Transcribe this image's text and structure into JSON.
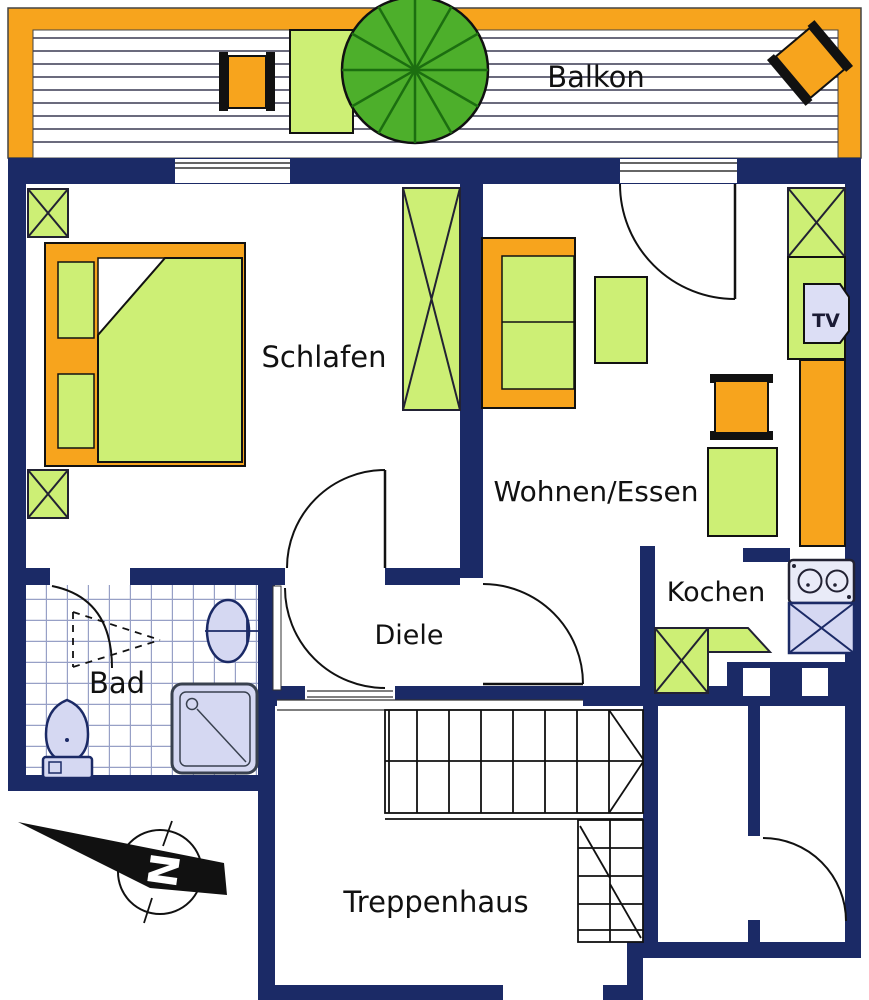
{
  "title": "Apartment floor plan",
  "rooms": {
    "balkon": {
      "label": "Balkon"
    },
    "schlafen": {
      "label": "Schlafen"
    },
    "wohnen_essen": {
      "label": "Wohnen/Essen"
    },
    "kochen": {
      "label": "Kochen"
    },
    "diele": {
      "label": "Diele"
    },
    "bad": {
      "label": "Bad"
    },
    "treppenhaus": {
      "label": "Treppenhaus"
    }
  },
  "furniture": {
    "tv_label": "TV"
  },
  "compass": {
    "north_label": "N"
  },
  "colors": {
    "wall_navy": "#1B2A66",
    "accent_orange": "#F7A41D",
    "furniture_green": "#CDEF75",
    "umbrella_green": "#4DAF2B",
    "umbrella_spoke_green": "#1C6E10",
    "fixture_lavender": "#D5D8F2",
    "tile_line": "#97A0C6",
    "floor_white": "#FFFFFF"
  }
}
